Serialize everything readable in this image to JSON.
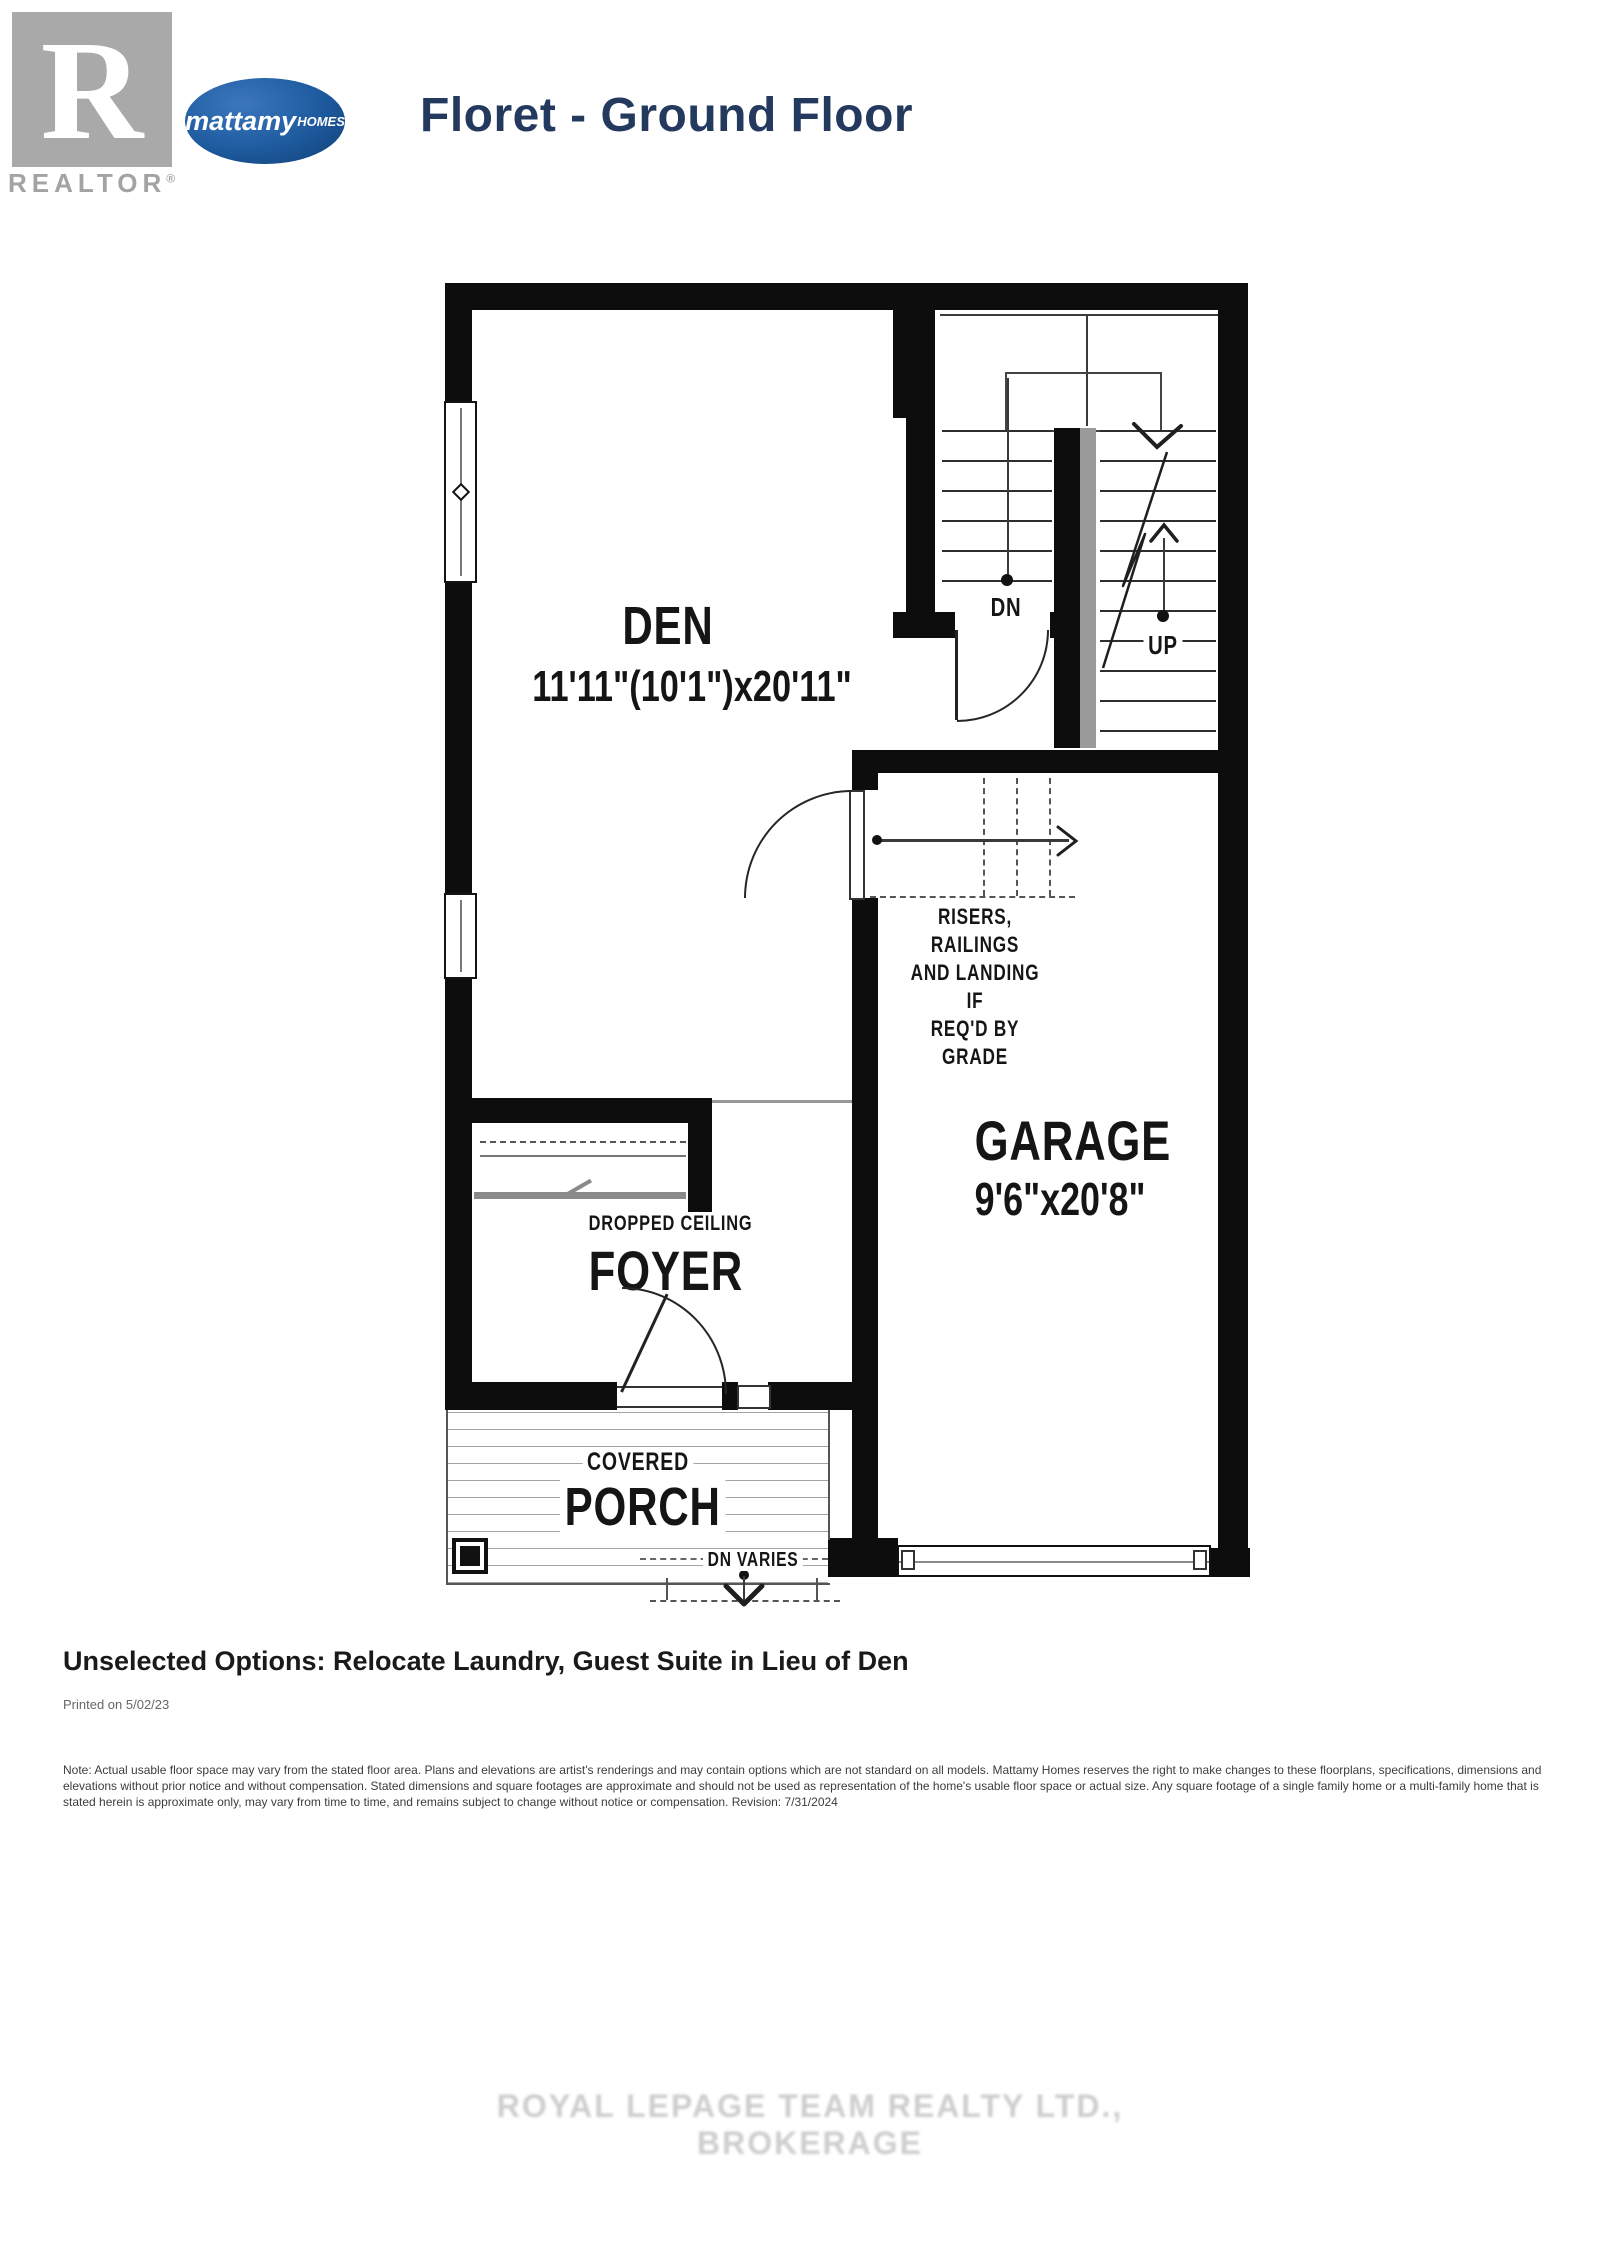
{
  "header": {
    "realtor_r": "R",
    "realtor_label": "REALTOR",
    "realtor_reg": "®",
    "brand_name": "mattamy",
    "brand_suffix": "HOMES",
    "title": "Floret - Ground Floor"
  },
  "plan": {
    "den": {
      "name": "DEN",
      "dims": "11'11\"(10'1\")x20'11\""
    },
    "garage": {
      "name": "GARAGE",
      "dims": "9'6\"x20'8\""
    },
    "foyer": {
      "name": "FOYER",
      "ceiling": "DROPPED CEILING"
    },
    "porch": {
      "prefix": "COVERED",
      "name": "PORCH",
      "dn_varies": "DN VARIES"
    },
    "stairs": {
      "dn": "DN",
      "up": "UP"
    },
    "risers_note": [
      "RISERS, RAILINGS",
      "AND LANDING IF",
      "REQ'D BY GRADE"
    ]
  },
  "footer": {
    "options": "Unselected Options: Relocate Laundry, Guest Suite in Lieu of Den",
    "printed": "Printed on 5/02/23",
    "disclaimer": "Note: Actual usable floor space may vary from the stated floor area. Plans and elevations are artist's renderings and may contain options which are not standard on all models. Mattamy Homes reserves the right to make changes to these floorplans, specifications, dimensions and elevations without prior notice and without compensation. Stated dimensions and square footages are approximate and should not be used as representation of the home's usable floor space or actual size. Any square footage of a single family home or a multi-family home that is stated herein is approximate only, may vary from time to time, and remains subject to change without notice or compensation. Revision: 7/31/2024"
  },
  "watermark": "ROYAL LEPAGE TEAM REALTY LTD., BROKERAGE"
}
